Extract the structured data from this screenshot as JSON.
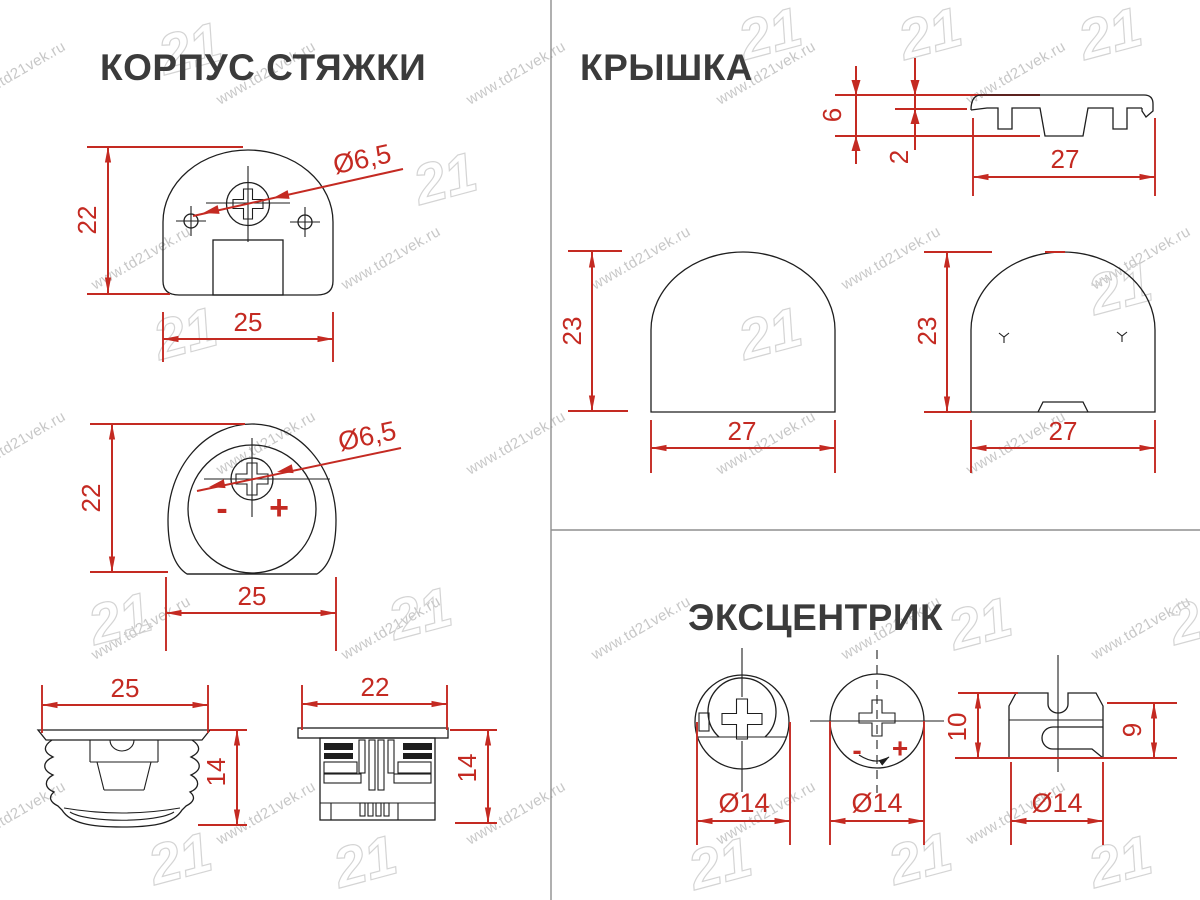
{
  "watermark": {
    "url": "www.td21vek.ru",
    "logo": "21"
  },
  "colors": {
    "dimension_red": "#c42a22",
    "drawing_black": "#1e1e1e",
    "title_gray": "#3b3b3b",
    "watermark_gray": "#b5b5b5",
    "divider_gray": "#8f8f8f"
  },
  "sections": {
    "korpus": {
      "title": "КОРПУС СТЯЖКИ",
      "front": {
        "height": "22",
        "width": "25",
        "hole": "Ø6,5"
      },
      "cam_view": {
        "height": "22",
        "width": "25",
        "hole": "Ø6,5",
        "minus": "-",
        "plus": "+"
      },
      "side_a": {
        "width": "25",
        "height": "14"
      },
      "side_b": {
        "width": "22",
        "height": "14"
      }
    },
    "kryshka": {
      "title": "КРЫШКА",
      "profile": {
        "height": "6",
        "thickness": "2",
        "width": "27"
      },
      "front": {
        "height": "23",
        "width": "27"
      },
      "back": {
        "height": "23",
        "width": "27"
      }
    },
    "excentrik": {
      "title": "ЭКСЦЕНТРИК",
      "top_closed": {
        "diameter": "Ø14"
      },
      "top_open": {
        "diameter": "Ø14",
        "minus": "-",
        "plus": "+"
      },
      "side": {
        "height_total": "10",
        "height_body": "9",
        "diameter": "Ø14"
      }
    }
  }
}
